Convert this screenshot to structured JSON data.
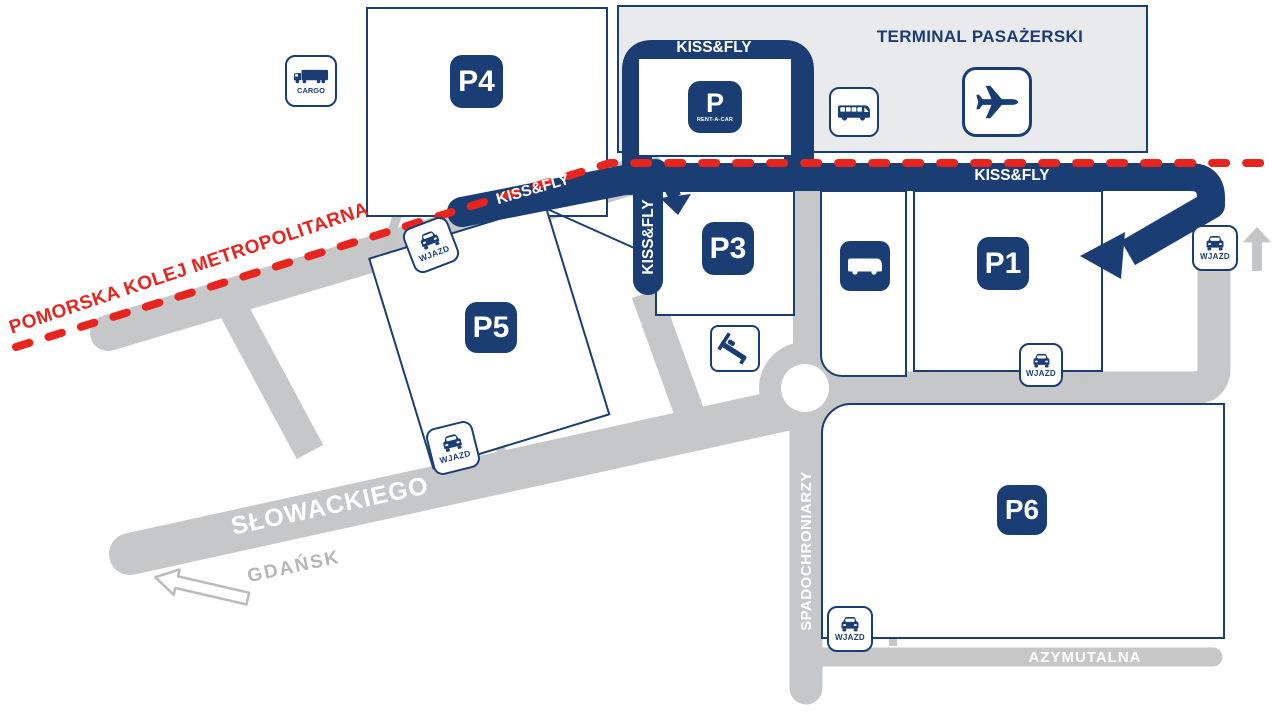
{
  "title": "Airport parking and access roads map",
  "colors": {
    "navy": "#1a3e73",
    "rail_red": "#e8241e",
    "road_gray": "#c5c7c9",
    "arrow_gray": "#c3c5c7",
    "terminal_fill": "#e9eaeb",
    "muted_gray_text": "#b4b6b8"
  },
  "labels": {
    "terminal": "TERMINAL PASAŻERSKI",
    "kissfly": "KISS&FLY",
    "wjazd": "WJAZD",
    "cargo": "CARGO",
    "p": "P",
    "rentacar": "RENT-A-CAR"
  },
  "parkings": {
    "p1": "P1",
    "p3": "P3",
    "p4": "P4",
    "p5": "P5",
    "p6": "P6"
  },
  "roads": {
    "slowackiego": "SŁOWACKIEGO",
    "spadochroniarzy": "SPADOCHRONIARZY",
    "azymutalna": "AZYMUTALNA",
    "gdansk": "GDAŃSK",
    "rail": "POMORSKA KOLEJ METROPOLITARNA"
  }
}
